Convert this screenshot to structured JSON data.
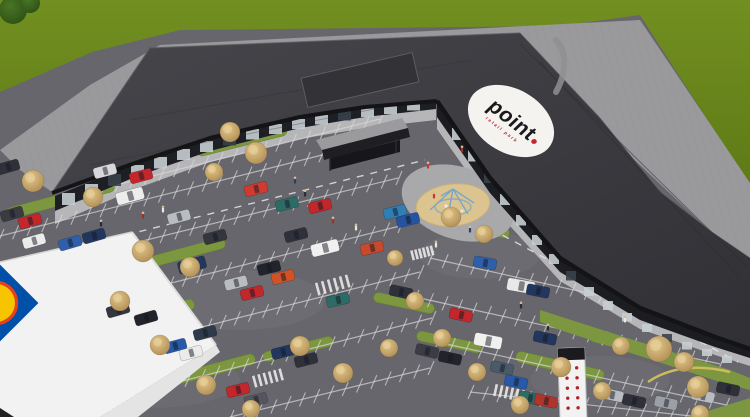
{
  "scene": {
    "logo": {
      "text": "point",
      "tagline": "retail park",
      "bg": "#f5f3ef",
      "text_color": "#1a1a1c",
      "accent": "#c1272b"
    },
    "supermarket_logo": {
      "square": "#0050aa",
      "disc": "#f6c500",
      "ring": "#e8401a"
    },
    "palette": {
      "grass": "#6e8b1e",
      "grass_dark": "#5e7a16",
      "asphalt": "#66666c",
      "pavement": "#9a9a9c",
      "roof": "#3a3a3f",
      "fascia": "#141417",
      "sidewalk": "#b6b6b8",
      "island": "#7c9740",
      "sand": "#dcc491",
      "tree": "#c9a96b",
      "white_roof": "#f2f2f2",
      "line": "#d9d9db"
    },
    "pylon": {
      "x": 571,
      "top": 348,
      "w": 27,
      "cap_h": 12,
      "dot_rows": 5,
      "dot_cols": 2,
      "dot_color": "#b32025"
    },
    "rows": [
      [
        88,
        192,
        380,
        119,
        20
      ],
      [
        0,
        236,
        350,
        148,
        24
      ],
      [
        0,
        276,
        398,
        178,
        27
      ],
      [
        55,
        312,
        400,
        226,
        24
      ],
      [
        95,
        354,
        420,
        272,
        23
      ],
      [
        115,
        398,
        432,
        318,
        22
      ],
      [
        230,
        417,
        430,
        368,
        14
      ],
      [
        430,
        258,
        700,
        318,
        19
      ],
      [
        415,
        297,
        720,
        364,
        21
      ],
      [
        437,
        342,
        740,
        408,
        21
      ],
      [
        470,
        392,
        700,
        417,
        16
      ]
    ],
    "islands": [
      [
        60,
        200,
        112,
        11,
        -15
      ],
      [
        166,
        258,
        122,
        11,
        -15
      ],
      [
        242,
        141,
        92,
        10,
        -14
      ],
      [
        468,
        226,
        84,
        10,
        11
      ],
      [
        404,
        303,
        62,
        10,
        12
      ],
      [
        449,
        342,
        66,
        10,
        12
      ],
      [
        140,
        318,
        112,
        11,
        -15
      ],
      [
        196,
        374,
        122,
        11,
        -15
      ],
      [
        298,
        349,
        72,
        10,
        -14
      ],
      [
        560,
        366,
        90,
        11,
        13
      ],
      [
        624,
        344,
        70,
        10,
        13
      ]
    ],
    "crosswalks": [
      [
        333,
        285,
        34,
        13,
        -15
      ],
      [
        135,
        363,
        30,
        12,
        -15
      ],
      [
        268,
        378,
        30,
        12,
        -15
      ],
      [
        122,
        403,
        28,
        11,
        -15
      ],
      [
        509,
        393,
        30,
        12,
        12
      ],
      [
        422,
        253,
        22,
        10,
        -14
      ]
    ],
    "dashes": [
      [
        58,
        252,
        425,
        160
      ],
      [
        478,
        222,
        738,
        362
      ]
    ],
    "cars": [
      [
        12,
        214,
        -16,
        "#3a3a42",
        "c"
      ],
      [
        30,
        221,
        -16,
        "#c1272b",
        "c"
      ],
      [
        34,
        241,
        -16,
        "#ebebeb",
        "c"
      ],
      [
        70,
        243,
        -16,
        "#2f5fa8",
        "c"
      ],
      [
        94,
        236,
        -16,
        "#23375e",
        "c"
      ],
      [
        8,
        167,
        -16,
        "#30303a",
        "c"
      ],
      [
        105,
        171,
        -15,
        "#d8d8da",
        "c"
      ],
      [
        141,
        176,
        -15,
        "#c1272b",
        "c"
      ],
      [
        130,
        196,
        -15,
        "#ededed",
        "v"
      ],
      [
        179,
        217,
        -15,
        "#b9bcc0",
        "c"
      ],
      [
        215,
        237,
        -15,
        "#35353d",
        "c"
      ],
      [
        256,
        189,
        -14,
        "#d03a30",
        "c"
      ],
      [
        287,
        204,
        -14,
        "#2c6b66",
        "c"
      ],
      [
        320,
        206,
        -14,
        "#c1272b",
        "c"
      ],
      [
        296,
        235,
        -14,
        "#30303a",
        "c"
      ],
      [
        325,
        248,
        -14,
        "#f0f0f0",
        "v"
      ],
      [
        372,
        248,
        -13,
        "#c84a2e",
        "c"
      ],
      [
        395,
        212,
        -14,
        "#2f7fb5",
        "c"
      ],
      [
        408,
        220,
        -14,
        "#2553a0",
        "c"
      ],
      [
        269,
        268,
        -14,
        "#23232b",
        "c"
      ],
      [
        283,
        277,
        -14,
        "#cf5327",
        "c"
      ],
      [
        236,
        283,
        -14,
        "#b9bcc0",
        "c"
      ],
      [
        252,
        293,
        -14,
        "#c1272b",
        "c"
      ],
      [
        192,
        265,
        -15,
        "#23375e",
        "v"
      ],
      [
        118,
        310,
        -16,
        "#35353d",
        "c"
      ],
      [
        146,
        318,
        -16,
        "#23232b",
        "c"
      ],
      [
        205,
        333,
        -15,
        "#2f3b4a",
        "c"
      ],
      [
        175,
        346,
        -15,
        "#2759a8",
        "c"
      ],
      [
        191,
        353,
        -15,
        "#ebebeb",
        "c"
      ],
      [
        283,
        352,
        -14,
        "#23375e",
        "c"
      ],
      [
        306,
        360,
        -14,
        "#30303a",
        "c"
      ],
      [
        238,
        390,
        -14,
        "#c1272b",
        "c"
      ],
      [
        256,
        400,
        -14,
        "#55555e",
        "c"
      ],
      [
        338,
        300,
        -13,
        "#2c6b66",
        "c"
      ],
      [
        401,
        292,
        12,
        "#30303a",
        "c"
      ],
      [
        485,
        263,
        10,
        "#2f5fa8",
        "c"
      ],
      [
        461,
        315,
        12,
        "#c1272b",
        "c"
      ],
      [
        521,
        286,
        10,
        "#e8e8e8",
        "v"
      ],
      [
        538,
        291,
        11,
        "#23375e",
        "c"
      ],
      [
        488,
        341,
        11,
        "#f0f0f0",
        "v"
      ],
      [
        427,
        351,
        13,
        "#3c3c44",
        "c"
      ],
      [
        450,
        358,
        12,
        "#23232b",
        "c"
      ],
      [
        545,
        338,
        12,
        "#23375e",
        "c"
      ],
      [
        502,
        368,
        12,
        "#4a5a6a",
        "c"
      ],
      [
        516,
        382,
        12,
        "#2759a8",
        "c"
      ],
      [
        530,
        398,
        12,
        "#2c6b66",
        "c"
      ],
      [
        546,
        401,
        12,
        "#b0342c",
        "c"
      ],
      [
        612,
        395,
        12,
        "#b9bcc0",
        "c"
      ],
      [
        634,
        401,
        12,
        "#30303a",
        "c"
      ],
      [
        666,
        403,
        12,
        "#9aa0a6",
        "c"
      ],
      [
        703,
        396,
        12,
        "#b9bcc0",
        "c"
      ],
      [
        728,
        389,
        12,
        "#30303a",
        "c"
      ]
    ],
    "trees": [
      [
        33,
        181,
        11
      ],
      [
        93,
        197,
        10
      ],
      [
        143,
        251,
        11
      ],
      [
        190,
        267,
        10
      ],
      [
        256,
        153,
        11
      ],
      [
        230,
        132,
        10
      ],
      [
        214,
        172,
        9
      ],
      [
        451,
        217,
        10
      ],
      [
        484,
        234,
        9
      ],
      [
        120,
        301,
        10
      ],
      [
        160,
        345,
        10
      ],
      [
        206,
        385,
        10
      ],
      [
        251,
        409,
        9
      ],
      [
        300,
        346,
        10
      ],
      [
        343,
        373,
        10
      ],
      [
        389,
        348,
        9
      ],
      [
        415,
        301,
        9
      ],
      [
        395,
        258,
        8
      ],
      [
        442,
        338,
        9
      ],
      [
        477,
        372,
        9
      ],
      [
        520,
        405,
        9
      ],
      [
        561,
        367,
        10
      ],
      [
        602,
        391,
        9
      ],
      [
        621,
        346,
        9
      ],
      [
        659,
        349,
        13
      ],
      [
        684,
        362,
        10
      ],
      [
        698,
        387,
        11
      ],
      [
        700,
        414,
        9
      ]
    ],
    "green_trees": [
      [
        13,
        10,
        14
      ],
      [
        30,
        3,
        10
      ]
    ],
    "people": [
      [
        101,
        227,
        "#2b2b33"
      ],
      [
        143,
        219,
        "#9e2f2a"
      ],
      [
        163,
        213,
        "#e8e8e8"
      ],
      [
        295,
        184,
        "#27406e"
      ],
      [
        305,
        197,
        "#2b2b33"
      ],
      [
        333,
        224,
        "#9e2f2a"
      ],
      [
        356,
        231,
        "#e8e8e8"
      ],
      [
        434,
        199,
        "#c23b30"
      ],
      [
        452,
        222,
        "#2b2b33"
      ],
      [
        470,
        233,
        "#27406e"
      ],
      [
        436,
        248,
        "#e8e8e8"
      ],
      [
        521,
        309,
        "#2b2b33"
      ],
      [
        462,
        153,
        "#9e2f2a"
      ],
      [
        428,
        169,
        "#c23b30"
      ],
      [
        548,
        331,
        "#2b2b33"
      ],
      [
        625,
        323,
        "#e8e8e8"
      ]
    ],
    "panels_a": [
      [
        62,
        193,
        12
      ],
      [
        85,
        184,
        12
      ],
      [
        108,
        174,
        12
      ],
      [
        131,
        165,
        11.5
      ],
      [
        154,
        157,
        11.5
      ],
      [
        177,
        149,
        11
      ],
      [
        200,
        141,
        11
      ],
      [
        223,
        135,
        10.5
      ],
      [
        246,
        129,
        10.5
      ],
      [
        269,
        124,
        10
      ],
      [
        292,
        119,
        10
      ],
      [
        315,
        115,
        9.5
      ],
      [
        338,
        111,
        9.5
      ],
      [
        361,
        108,
        9
      ],
      [
        384,
        105,
        9
      ],
      [
        407,
        102,
        8.5
      ]
    ],
    "panels_b": [
      [
        452,
        128,
        12
      ],
      [
        468,
        150,
        11.5
      ],
      [
        484,
        172,
        11
      ],
      [
        500,
        194,
        11
      ],
      [
        516,
        215,
        10.5
      ],
      [
        532,
        235,
        10
      ],
      [
        549,
        254,
        10
      ],
      [
        566,
        271,
        9.5
      ],
      [
        584,
        287,
        9
      ],
      [
        603,
        301,
        9
      ],
      [
        622,
        313,
        8.5
      ],
      [
        642,
        324,
        8
      ],
      [
        662,
        334,
        8
      ],
      [
        682,
        342,
        7.5
      ],
      [
        702,
        349,
        7
      ],
      [
        722,
        356,
        7
      ]
    ]
  }
}
